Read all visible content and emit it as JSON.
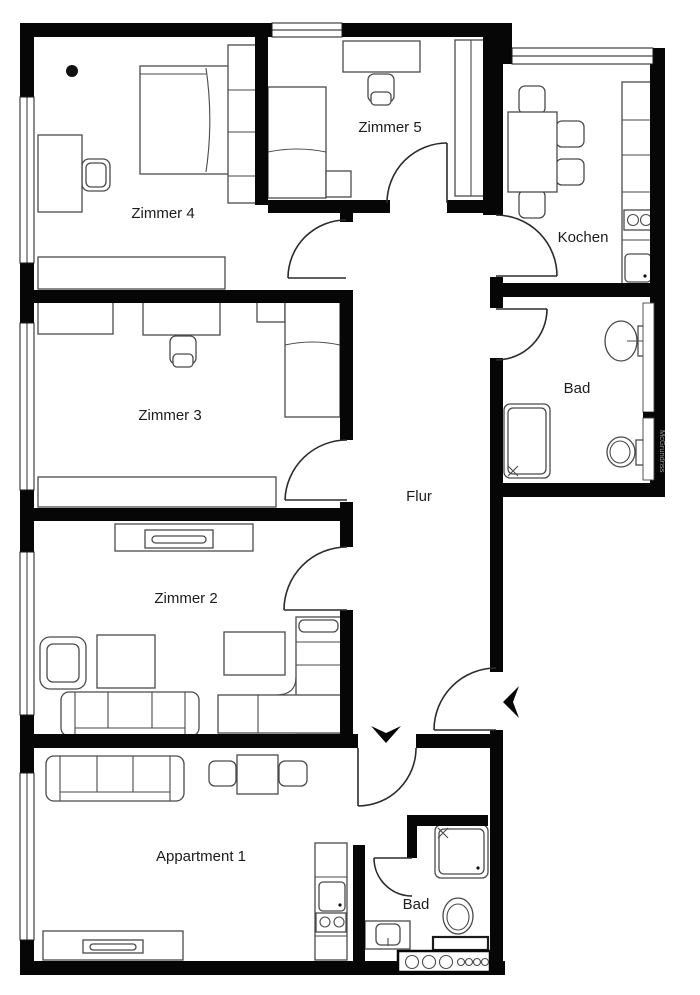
{
  "title": "Apartment floor plan",
  "colors": {
    "wall": "#060606",
    "furniture_outline": "#4a4a4a",
    "door_arc": "#2b2b2b",
    "background": "#ffffff",
    "label": "#1c1c1c",
    "watermark": "#9a9a9a"
  },
  "rooms": {
    "zimmer4": {
      "label": "Zimmer 4"
    },
    "zimmer5": {
      "label": "Zimmer 5"
    },
    "kochen": {
      "label": "Kochen"
    },
    "bad": {
      "label": "Bad"
    },
    "zimmer3": {
      "label": "Zimmer 3"
    },
    "flur": {
      "label": "Flur"
    },
    "zimmer2": {
      "label": "Zimmer 2"
    },
    "appartment1": {
      "label": "Appartment 1"
    },
    "bad_appartment1": {
      "label": "Bad"
    }
  },
  "watermark": "McGrundriss"
}
